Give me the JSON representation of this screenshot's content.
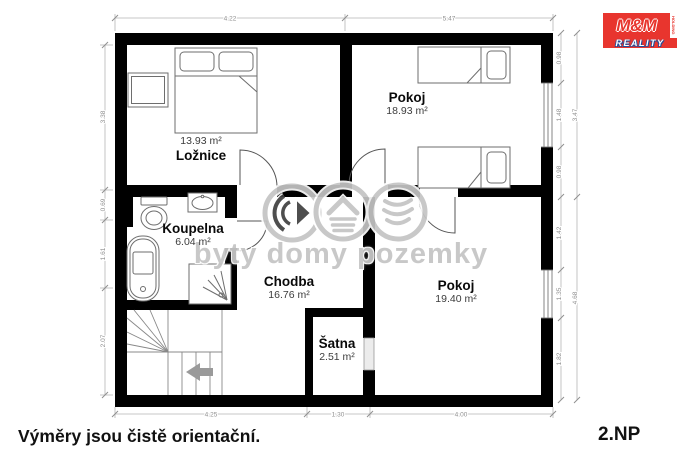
{
  "meta": {
    "floor_label": "2.NP",
    "disclaimer": "Výměry jsou čistě orientační."
  },
  "branding": {
    "logo_text": "M&M",
    "logo_side_text": "HOLDING",
    "logo_band_text": "REALITY",
    "logo_red": "#e8352e",
    "logo_blue": "#1d4f9e"
  },
  "watermark": {
    "text": "byty domy pozemky",
    "color": "#c6c6c6",
    "icons": [
      "play-badge-icon",
      "house-badge-icon",
      "land-badge-icon"
    ]
  },
  "rooms": [
    {
      "name": "Ložnice",
      "area": "13.93 m²"
    },
    {
      "name": "Pokoj",
      "area": "18.93 m²"
    },
    {
      "name": "Koupelna",
      "area": "6.04 m²"
    },
    {
      "name": "Chodba",
      "area": "16.76 m²"
    },
    {
      "name": "Šatna",
      "area": "2.51 m²"
    },
    {
      "name": "Pokoj",
      "area": "19.40 m²"
    }
  ],
  "dimensions": {
    "top": [
      "4.22",
      "5.47"
    ],
    "bottom": [
      "4.25",
      "1.30",
      "4.00"
    ],
    "left": [
      "3.38",
      "0.69",
      "1.61",
      "2.07"
    ],
    "right_inner": [
      "0.98",
      "1.48",
      "0.98",
      "1.42",
      "1.35",
      "1.82"
    ],
    "right_outer": [
      "3.47",
      "4.68"
    ]
  }
}
